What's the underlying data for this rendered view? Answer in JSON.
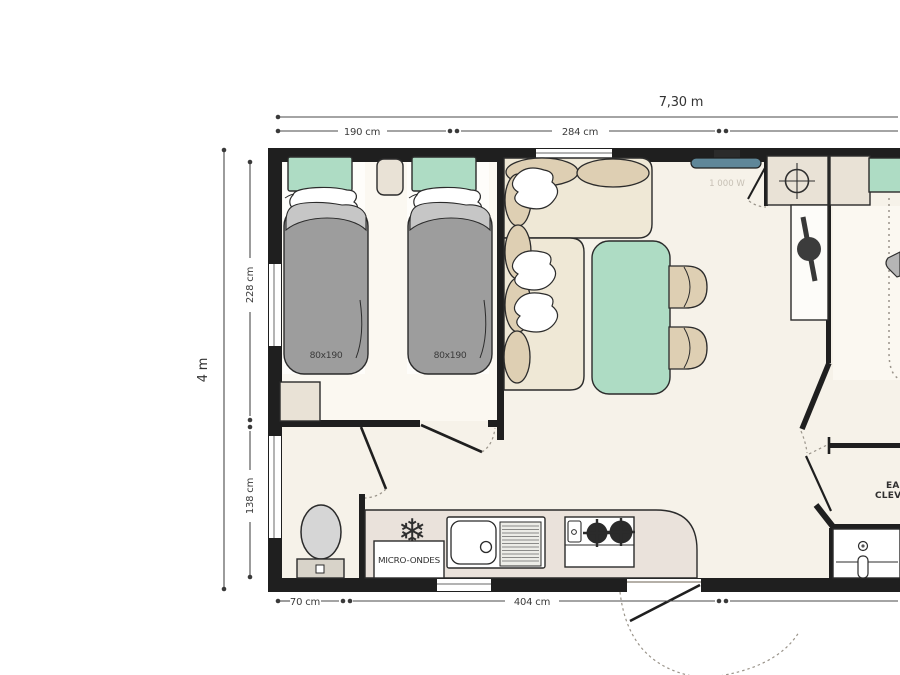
{
  "dimensions": {
    "total_width": "7,30 m",
    "total_depth": "4 m",
    "top_segment_1": "190 cm",
    "top_segment_2": "284 cm",
    "left_segment_1": "228 cm",
    "left_segment_2": "138 cm",
    "bottom_segment_1": "70 cm",
    "bottom_segment_2": "404 cm"
  },
  "labels": {
    "bed1_size": "80x190",
    "bed2_size": "80x190",
    "tv_power": "1 000 W",
    "microwave": "MICRO-ONDES",
    "brand_line1": "EASY",
    "brand_line2": "CLEVER"
  },
  "icons": {
    "fridge": "❄"
  },
  "colors": {
    "wall": "#1f1f1f",
    "floor": "#f6f2e9",
    "accent_green": "#aedcc4",
    "upholstery_tan": "#decfb3",
    "sofa_beige": "#efe8d6",
    "mattress_gray": "#9d9d9d",
    "counter_pink": "#eae2db",
    "tv_teal": "#5f8799"
  }
}
